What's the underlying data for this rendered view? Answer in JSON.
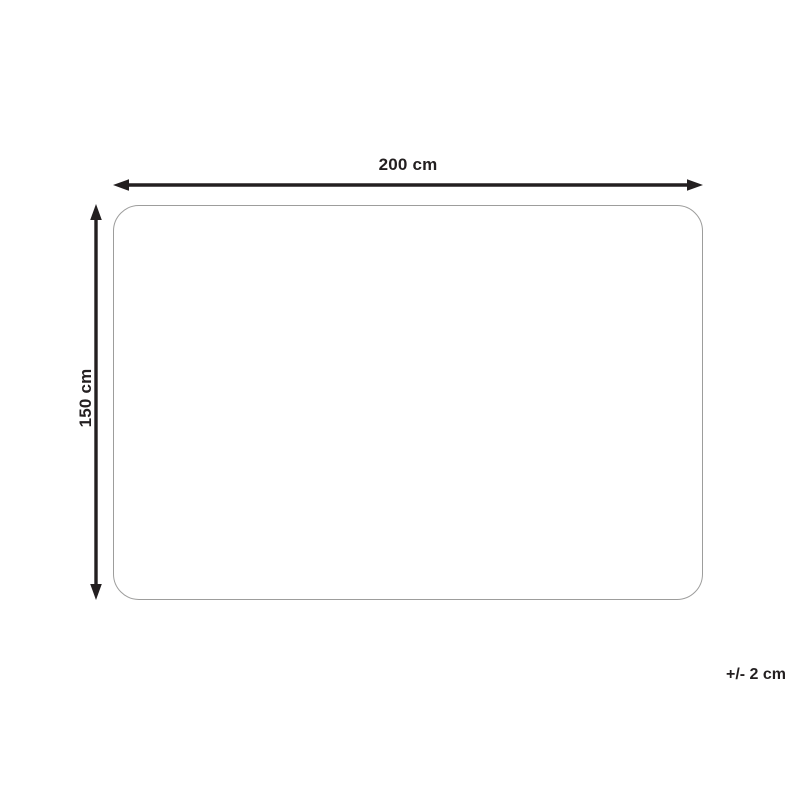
{
  "diagram": {
    "width_label": "200 cm",
    "height_label": "150 cm",
    "tolerance_label": "+/- 2 cm",
    "outline_color": "#9d9d9c",
    "arrow_color": "#231f20",
    "background_color": "#ffffff"
  }
}
